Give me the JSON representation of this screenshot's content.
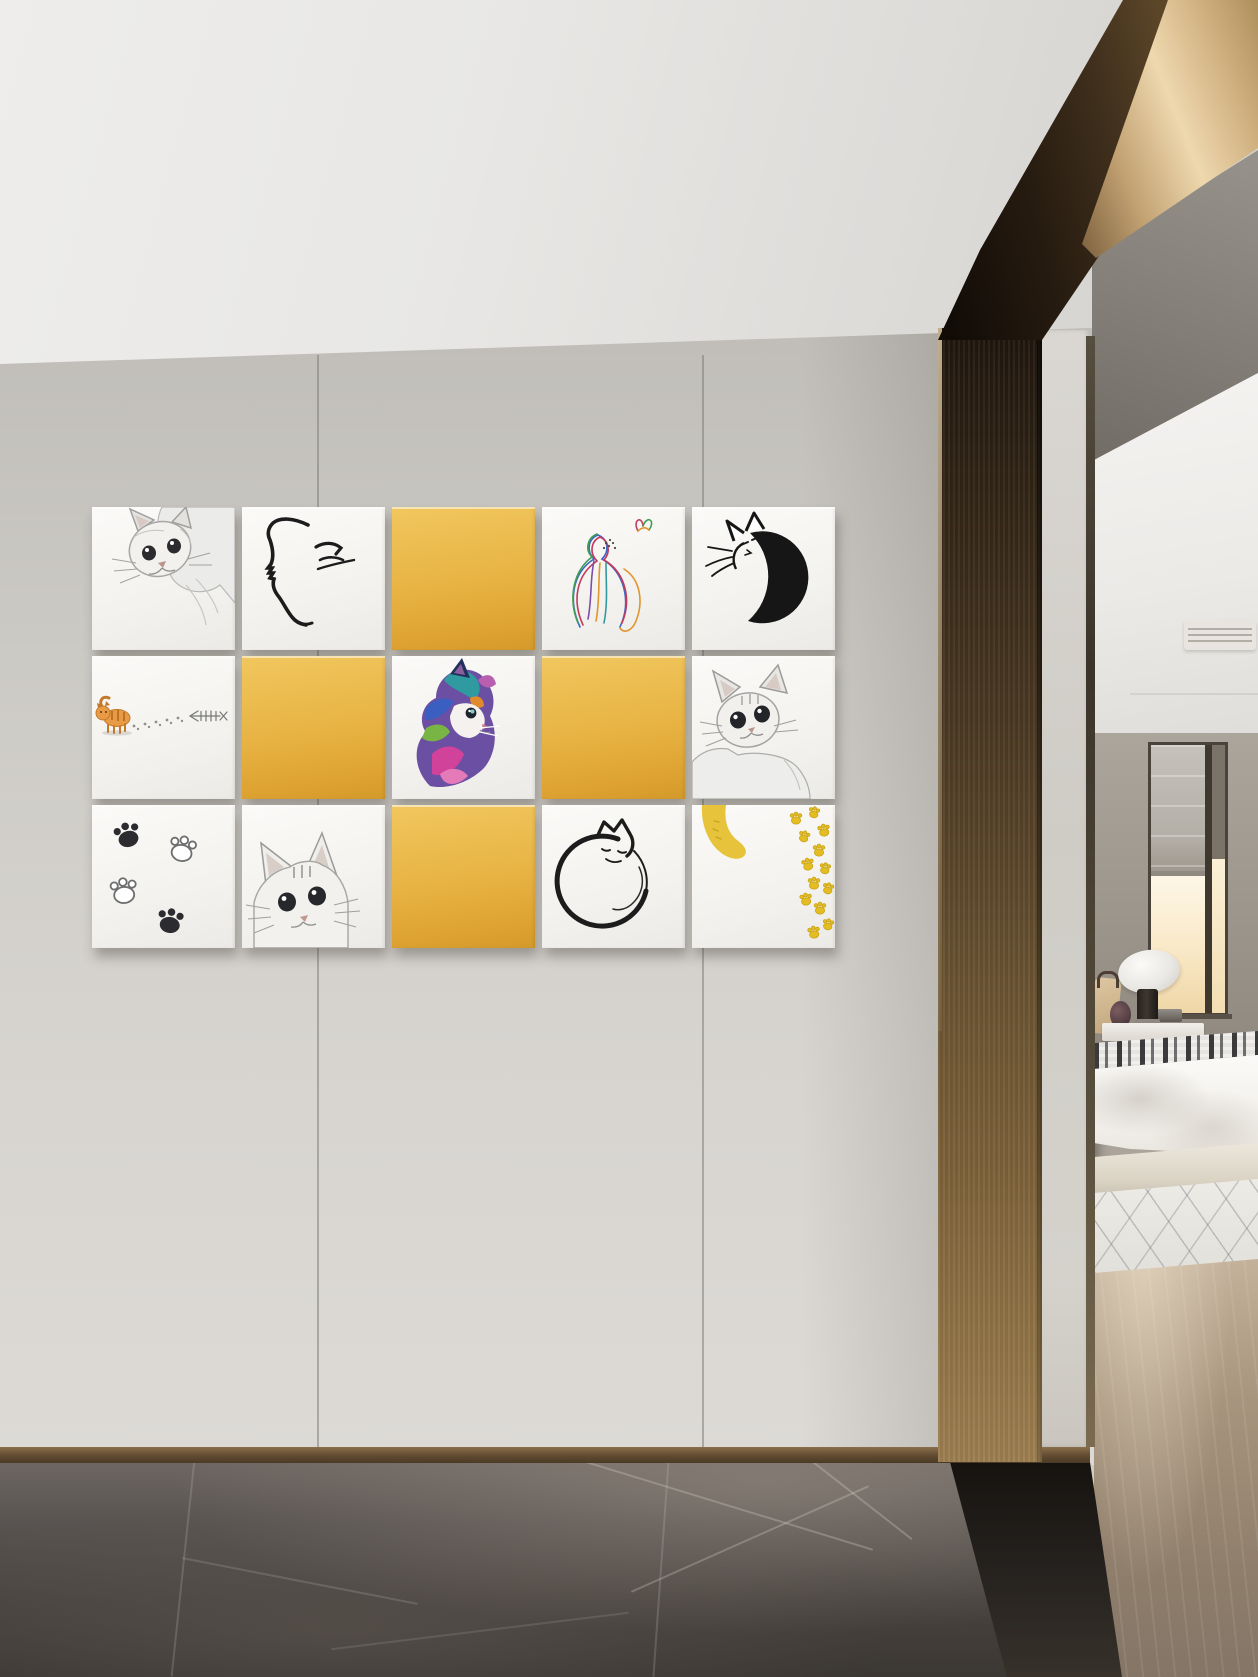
{
  "scene": {
    "setting": "hallway interior with cat-themed gallery wall beside bronze-framed doorway into bedroom",
    "wall_art": {
      "rows": 3,
      "cols": 5,
      "tiles": [
        {
          "row": 1,
          "col": 1,
          "motif": "gray sketched cat peeking down from the top right corner",
          "style": "pencil sketch"
        },
        {
          "row": 1,
          "col": 2,
          "motif": "minimal black ink cat head profile with closed-eye strokes",
          "style": "line art"
        },
        {
          "row": 1,
          "col": 3,
          "motif": "solid yellow panel",
          "style": "plain"
        },
        {
          "row": 1,
          "col": 4,
          "motif": "thin rainbow-line cat seen from behind with butterfly",
          "style": "line art"
        },
        {
          "row": 1,
          "col": 5,
          "motif": "black crescent-moon cat with outlined ears and whiskers",
          "style": "line art"
        },
        {
          "row": 2,
          "col": 1,
          "motif": "orange kitten walking left leaving a paw-print trail toward a fish skeleton",
          "style": "watercolor cartoon"
        },
        {
          "row": 2,
          "col": 2,
          "motif": "solid yellow panel",
          "style": "plain"
        },
        {
          "row": 2,
          "col": 3,
          "motif": "rainbow painted kitten facing right",
          "style": "colorful painting"
        },
        {
          "row": 2,
          "col": 4,
          "motif": "solid yellow panel",
          "style": "plain"
        },
        {
          "row": 2,
          "col": 5,
          "motif": "gray sketched wide-eyed cat peeking up from the bottom",
          "style": "pencil sketch"
        },
        {
          "row": 3,
          "col": 1,
          "motif": "four paw prints, two solid black and two outlined",
          "style": "line art"
        },
        {
          "row": 3,
          "col": 2,
          "motif": "gray sketched cat head rising from the bottom edge",
          "style": "pencil sketch"
        },
        {
          "row": 3,
          "col": 3,
          "motif": "solid yellow panel",
          "style": "plain"
        },
        {
          "row": 3,
          "col": 4,
          "motif": "black line cat curled into a circle sleeping",
          "style": "line art"
        },
        {
          "row": 3,
          "col": 5,
          "motif": "yellow cat tail with stitch marks and trail of yellow paw prints",
          "style": "flat illustration"
        }
      ]
    },
    "architecture": {
      "ceiling": "white plaster ceiling",
      "beam": "diagonal brushed bronze ceiling beam",
      "column": "floor-to-ceiling bronze door pillar",
      "jamb": "light gray door jamb",
      "wall": "warm gray fabric-panel wall with two vertical seams",
      "baseboard": "bronze metal skirting strip",
      "hall_floor": "dark gray marble tiles with white veining",
      "threshold": "near-black marble threshold band"
    },
    "bedroom": {
      "items": [
        "white ceiling with linear air vent",
        "window with gray roman blind and warm sunlight",
        "white dome table lamp with dark cylindrical base",
        "tan cushion and dark vase on white nightstand",
        "bed with black-and-white patterned throw and white duvet",
        "light rug with thin crossing lines",
        "light wood floor"
      ]
    },
    "palette": {
      "wall_gray": "#cccac5",
      "ceiling_white": "#eceae8",
      "accent_yellow": "#e7b242",
      "bronze_dark": "#2c2013",
      "bronze_light": "#eed8ae",
      "marble_dark": "#47423e",
      "wood_floor": "#a8957e",
      "window_glow": "#f9e8c6",
      "ink_black": "#1c1c1c"
    }
  }
}
